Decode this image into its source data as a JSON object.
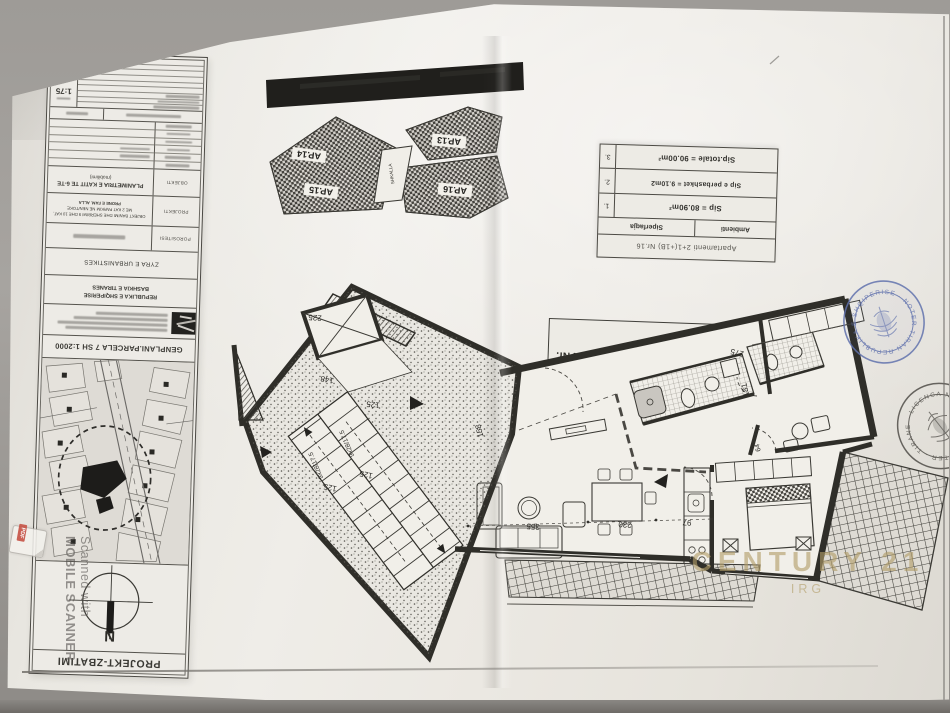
{
  "title_block": {
    "sheet_code": "A-",
    "scale": "1:75",
    "objekti_label": "OBJEKTI",
    "objekti_line1": "PLANIMETRIA E KATIT TE 6-TE",
    "objekti_line2": "(mobilimi)",
    "projekti_label": "PROJEKTI",
    "projekti_line1": "OBJEKT BANIMI DHE SHERBIMI 9 DHE 10 KAT,",
    "projekti_line2": "ME 2 KAT PARKIM NE NEN/TOKE",
    "projekti_line3": "PRONE E FAM. ALLA",
    "porosites_label": "POROSITESI",
    "office_row": "ZYRA E URBANISTIKES",
    "authority_line1": "REPUBLIKA E SHQIPERISE",
    "authority_line2": "BASHKIA E TIRANES",
    "genplan_title": "GENPLANI.PARCELA 7 SH 1:2000",
    "compass_label": "N",
    "footer": "PROJEKT-ZBATIMI"
  },
  "key_plan": {
    "units": [
      "AP.13",
      "AP.14",
      "AP.15",
      "AP.16"
    ],
    "stair_label": "SHKALLA"
  },
  "plan_title_box": {
    "title": "Planimetria e mobilimit te apartamentit Nr. 16",
    "scale_note": "(shk. 1:75)"
  },
  "area_table": {
    "header": "Apartamenti  2+1(+1B)  Nr.16",
    "columns": [
      "Ambienti",
      "Siperfaqja"
    ],
    "rows": [
      {
        "no": "1.",
        "value": "Sip  =  80.90m²"
      },
      {
        "no": "2.",
        "value": "Sip e perbashket = 9.10m2"
      },
      {
        "no": "3.",
        "value": "Sip.totale  =  90.00m²"
      }
    ]
  },
  "floor_plan": {
    "dimensions": {
      "elevator": "225",
      "hall": "148",
      "stair_top": "125",
      "stair_bottom_a": "125",
      "stair_bottom_b": "125",
      "stair_run_a": "9x28/17.5",
      "stair_run_b": "9x28/17.5",
      "entry": "158",
      "living": "355",
      "dining": "230",
      "kitchen": "97",
      "bedroom_top": "275",
      "bedroom_side": "181",
      "door": "64"
    }
  },
  "stamps": {
    "notary_blue": {
      "ring_text": "REPUBLIKA E SHQIPERISE · NOTER TIRANE ·",
      "color": "#5f70ab"
    },
    "notary_black": {
      "ring_text": "NOTER · TIRANE · LICENCA NR ·",
      "color": "#46443f"
    }
  },
  "watermarks": {
    "scanner": {
      "line1": "Scanned with",
      "line2": "MOBILE SCANNER",
      "icon_label": "PDF"
    },
    "brand": {
      "name": "CENTURY 21",
      "sub": "IRG"
    }
  }
}
